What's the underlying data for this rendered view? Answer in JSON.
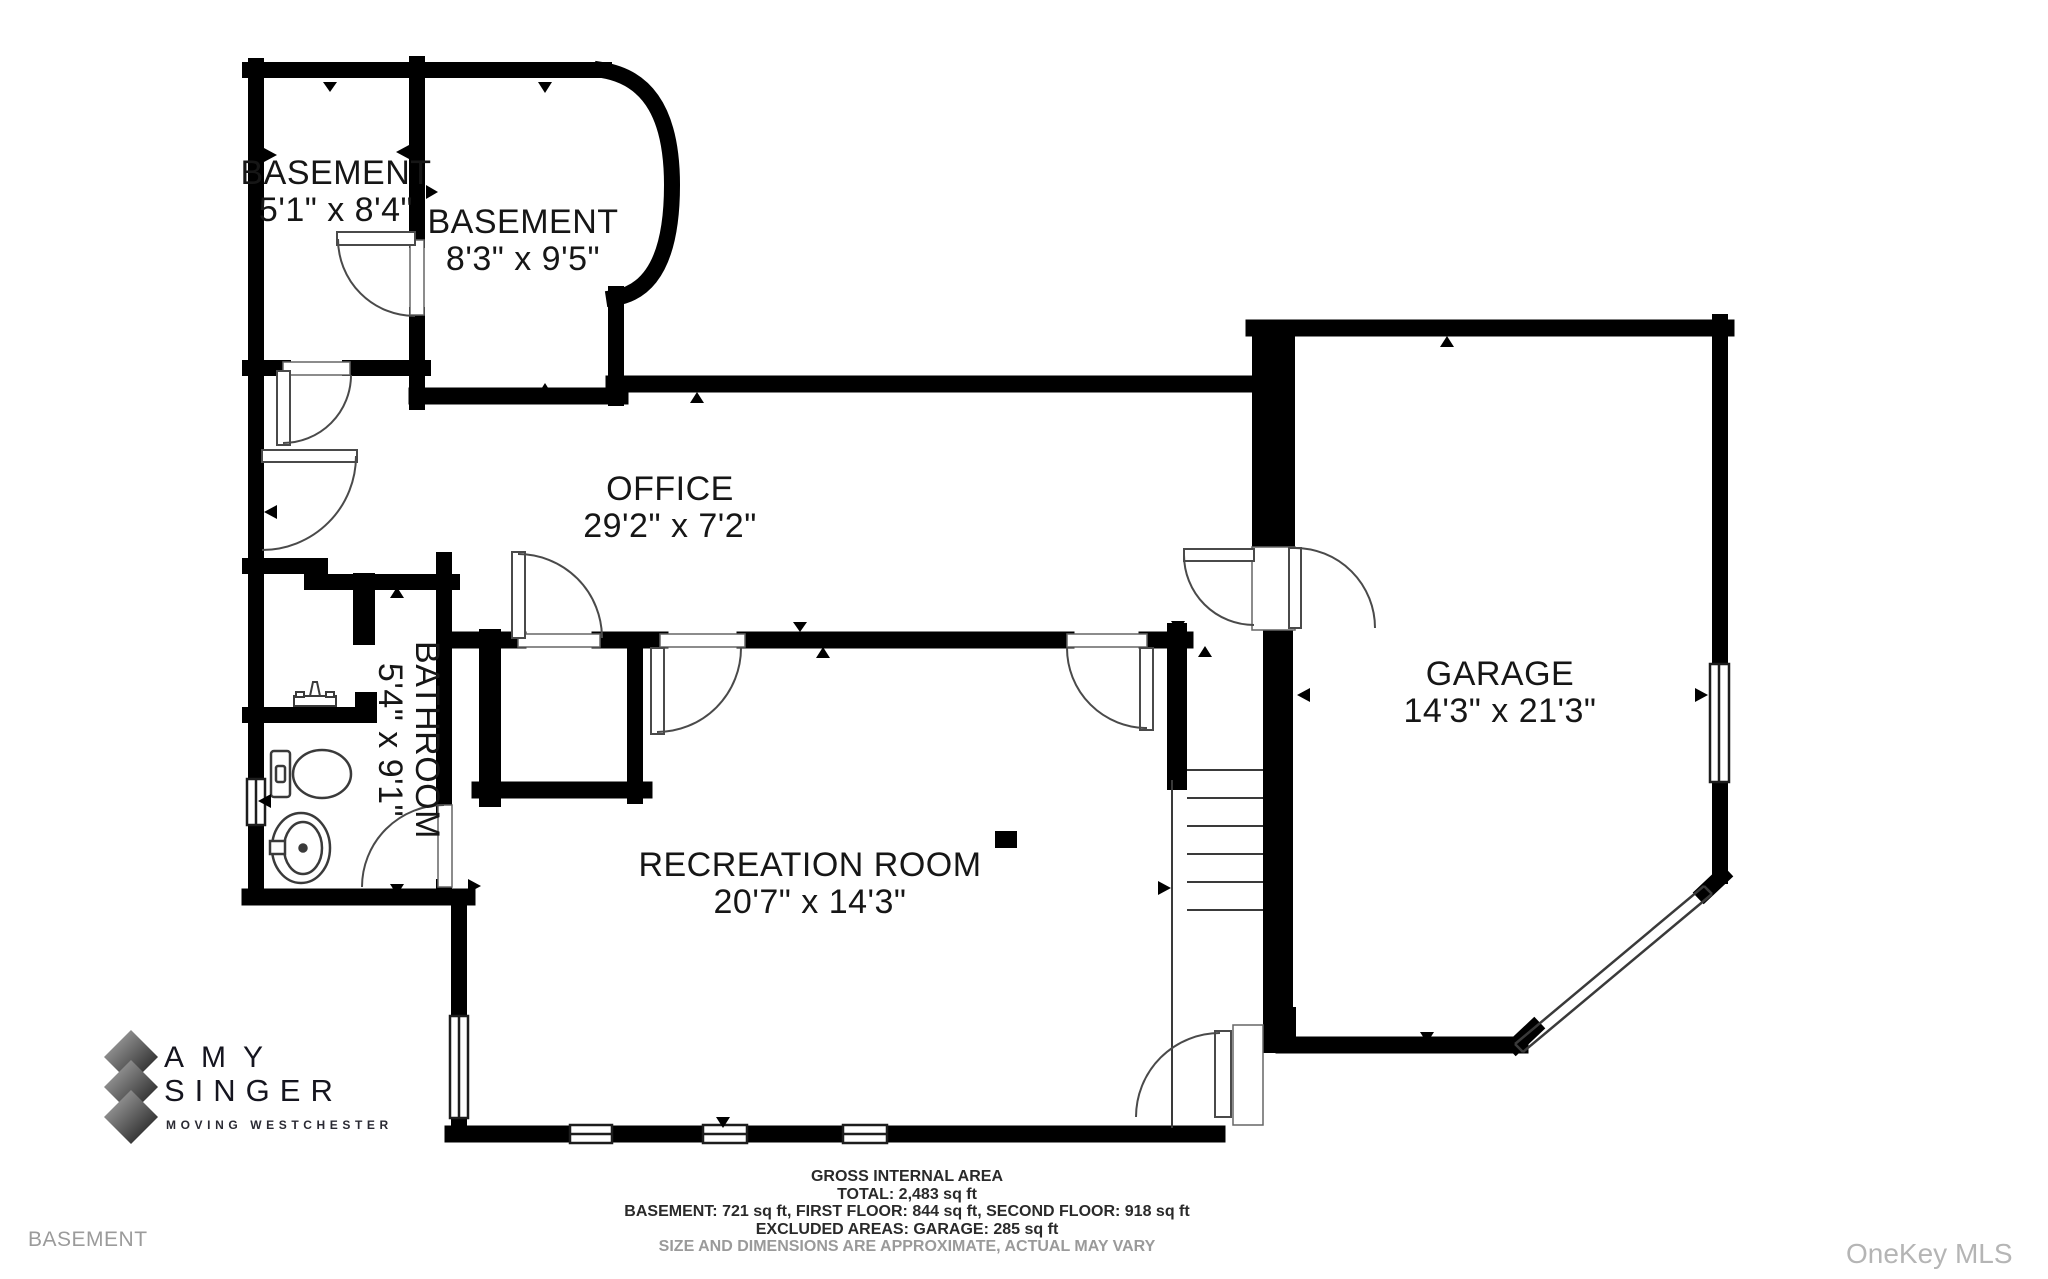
{
  "page": {
    "floor_label": "BASEMENT",
    "watermark": "OneKey MLS"
  },
  "colors": {
    "wall": "#000000",
    "fixture_line": "#3a3a3a",
    "label_text": "#161616",
    "muted_text": "#9b9b9b",
    "watermark_text": "#b5b5b5"
  },
  "rooms": {
    "basement_small": {
      "name": "BASEMENT",
      "dims": "5'1\" x 8'4\""
    },
    "basement_large": {
      "name": "BASEMENT",
      "dims": "8'3\" x 9'5\""
    },
    "office": {
      "name": "OFFICE",
      "dims": "29'2\" x 7'2\""
    },
    "bathroom": {
      "name": "BATHROOM",
      "dims": "5'4\" x 9'1\""
    },
    "recreation": {
      "name": "RECREATION ROOM",
      "dims": "20'7\" x 14'3\""
    },
    "garage": {
      "name": "GARAGE",
      "dims": "14'3\" x 21'3\""
    }
  },
  "logo": {
    "line1": "AMY",
    "line2": "SINGER",
    "tagline": "MOVING WESTCHESTER"
  },
  "footer": {
    "title": "GROSS INTERNAL AREA",
    "total": "TOTAL: 2,483 sq ft",
    "floors": "BASEMENT: 721 sq ft, FIRST FLOOR: 844 sq ft, SECOND FLOOR: 918 sq ft",
    "excluded": "EXCLUDED AREAS: GARAGE: 285 sq ft",
    "disclaimer": "SIZE AND DIMENSIONS ARE APPROXIMATE, ACTUAL MAY VARY"
  }
}
